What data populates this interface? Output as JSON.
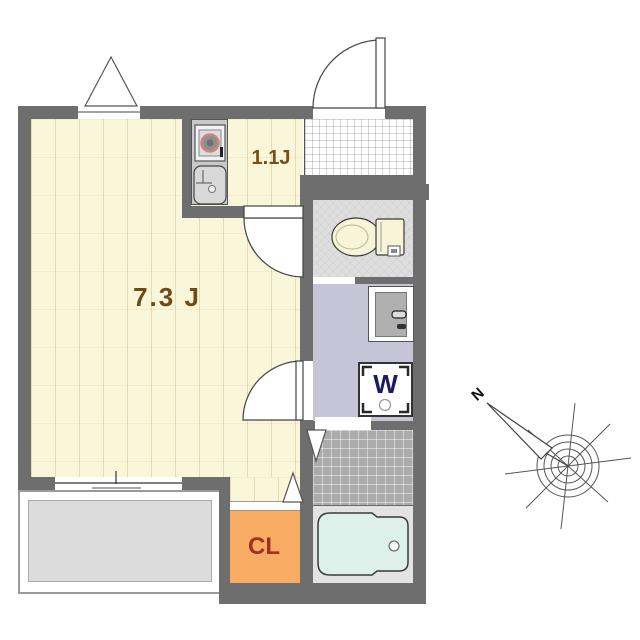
{
  "title": "apartment floor plan",
  "rooms": {
    "living": {
      "label": "7.3 J"
    },
    "kitchen": {
      "label": "1.1J"
    },
    "closet": {
      "label": "CL"
    },
    "washer": {
      "label": "W"
    }
  },
  "compass": {
    "north": "N"
  },
  "colors": {
    "wall": "#6e6e6e",
    "room_floor": "#faf6da",
    "kitchen_counter": "#c9c9c9",
    "entry_tile": "#ffffff",
    "toilet_floor": "#dedede",
    "washroom_floor": "#c6c5d7",
    "bath_tile": "#ababab",
    "bathtub": "#ddf1ea",
    "tub_platform": "#e3e3e3",
    "closet": "#f8ab63",
    "closet_text": "#9e3122",
    "room_label_text": "#6f4a15",
    "washer_text": "#1a1a66",
    "balcony_floor": "#dcdcdc"
  },
  "fixtures": [
    "stove",
    "sink",
    "toilet",
    "vanity-basin",
    "washing-machine",
    "bathtub"
  ]
}
